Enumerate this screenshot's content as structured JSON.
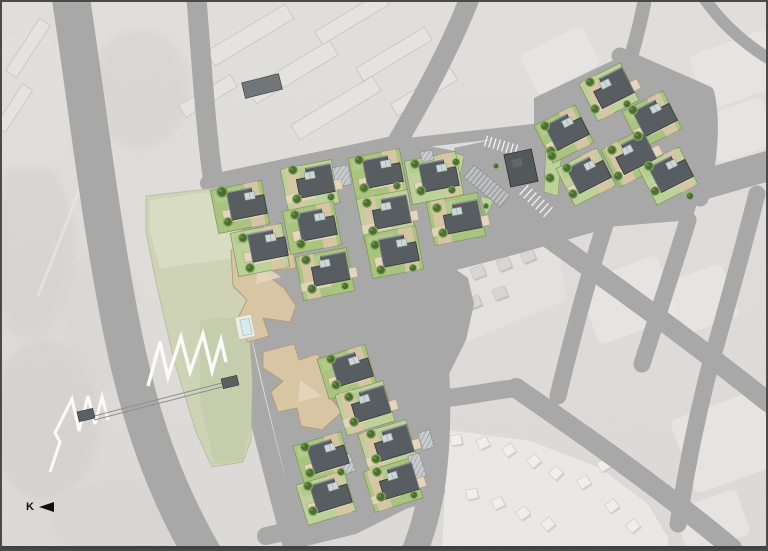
{
  "meta": {
    "description": "Architectural site plan of a housing development overlaid on a grayscale aerial photograph",
    "width": 768,
    "height": 551
  },
  "north_indicator": {
    "label": "K"
  },
  "palette": {
    "road": "#a8a8a8",
    "aerialBase": "#dcdbd8",
    "aerialTop": "#e1e0dd",
    "aerialLight": "#e9e8e5",
    "aerialMid": "#cfcecb",
    "parkFill": "#ced3b5",
    "parkLight": "#dadec6",
    "parkDark": "#c3cba8",
    "lawnA": "#a9c47f",
    "lawnB": "#bdd29a",
    "lawnStroke": "#7c9454",
    "tan": "#d8c5a4",
    "tanLight": "#e4d6bb",
    "tanStroke": "#b39c76",
    "roof": "#585d62",
    "roofDark": "#33383c",
    "roofLight": "#8a9094",
    "sky": "#cdd8d5",
    "skyStroke": "#8fa3a8",
    "treeOuter": "#86aa60",
    "treeInner": "#4b6e33",
    "treeDot": "#6d9449",
    "poolFill": "#d7ecf0",
    "poolStroke": "#9cc0c9",
    "deck": "#efece4",
    "darkBld": "#53585b",
    "darkBldEdge": "#2e3234",
    "hatchBg": "#c9ccce",
    "hatchLine": "#8f9498",
    "stall": "#8a8d8f",
    "stallBand": "#bfc1c1",
    "white": "#f4f4f2",
    "exHouse": "#d8d7d4",
    "exShadow": "#b9b8b5",
    "subHouse": "#f2f1ee",
    "subShadow": "#c9c8c5",
    "aptBar": "#e6e5e2",
    "aptStroke": "#c6c5c2",
    "aptPool": "#6e7478",
    "bridge": "#8f8f8d",
    "zigzag": "#fbfbf9",
    "frame": "#4a4a4a",
    "frameBottom": "#414141"
  },
  "aerial": {
    "blobs": [
      [
        30,
        250,
        45,
        90,
        "#d2d1ce",
        0.5
      ],
      [
        45,
        420,
        55,
        80,
        "#cdccc9",
        0.45
      ],
      [
        28,
        100,
        50,
        70,
        "#e3e2df",
        0.6
      ],
      [
        120,
        520,
        70,
        40,
        "#d5d4d1",
        0.5
      ],
      [
        140,
        90,
        50,
        60,
        "#d0cfcc",
        0.4
      ],
      [
        330,
        470,
        60,
        40,
        "#e6e5e2",
        0.5
      ],
      [
        100,
        320,
        40,
        70,
        "#d8d7d4",
        0.5
      ]
    ],
    "trail": "M96,140 C80,190 60,240 38,296",
    "bars": [
      [
        250,
        35,
        92,
        17,
        -31
      ],
      [
        293,
        72,
        95,
        17,
        -31
      ],
      [
        336,
        108,
        95,
        17,
        -31
      ],
      [
        352,
        18,
        78,
        15,
        -31
      ],
      [
        394,
        54,
        80,
        15,
        -31
      ],
      [
        424,
        92,
        70,
        14,
        -31
      ],
      [
        208,
        96,
        60,
        14,
        -31
      ],
      [
        28,
        48,
        62,
        13,
        -57
      ],
      [
        14,
        108,
        50,
        12,
        -57
      ]
    ],
    "apt_pool": [
      262,
      86,
      38,
      16,
      -14
    ],
    "blocks": [
      [
        628,
        300,
        84,
        66,
        -20
      ],
      [
        700,
        300,
        64,
        56,
        -20
      ],
      [
        726,
        442,
        92,
        78,
        -20
      ],
      [
        737,
        70,
        82,
        58,
        -20
      ],
      [
        712,
        522,
        66,
        48,
        -20
      ],
      [
        740,
        130,
        60,
        50,
        -20
      ],
      [
        560,
        60,
        70,
        44,
        -27
      ]
    ],
    "mid_block": "372,292 540,243 560,252 566,300 442,352 386,332",
    "mid_houses": [
      [
        400,
        298
      ],
      [
        426,
        290
      ],
      [
        452,
        281
      ],
      [
        478,
        272
      ],
      [
        504,
        264
      ],
      [
        528,
        256
      ],
      [
        396,
        327
      ],
      [
        422,
        319
      ],
      [
        448,
        310
      ],
      [
        474,
        302
      ],
      [
        500,
        293
      ]
    ],
    "mid_house_rot": -21,
    "sub_block": "448,430 530,441 600,468 648,504 668,538 668,551 442,551",
    "sub_houses": [
      [
        456,
        440,
        -10
      ],
      [
        483,
        443,
        -25
      ],
      [
        509,
        450,
        -35
      ],
      [
        534,
        461,
        -40
      ],
      [
        556,
        473,
        -45
      ],
      [
        472,
        494,
        -12
      ],
      [
        498,
        503,
        -25
      ],
      [
        523,
        513,
        -35
      ],
      [
        548,
        524,
        -40
      ],
      [
        584,
        482,
        -30
      ],
      [
        604,
        465,
        -30
      ],
      [
        612,
        506,
        -35
      ],
      [
        633,
        526,
        -40
      ]
    ]
  },
  "ground_areas": [
    "226,186 398,142 452,152 468,162 492,240 462,252 432,264 424,298 432,380 438,462 420,502 356,534 298,548 284,472 266,398 250,330 234,262",
    "454,148 546,128 560,162 562,224 476,242",
    "534,98 622,56 706,94 712,152 692,220 546,232 534,152",
    "388,270 418,264 448,264 468,278 474,304 466,340 450,372 436,398 426,380 418,312"
  ],
  "roads": [
    {
      "d": "M70,-8 C88,110 100,220 122,330 C140,420 165,490 205,558",
      "w": 38
    },
    {
      "d": "M196,-8 C202,70 206,130 213,180 C222,240 232,300 248,370 C262,430 278,490 296,558",
      "w": 20
    },
    {
      "d": "M208,183 L398,143",
      "w": 16
    },
    {
      "d": "M472,-8 C452,45 422,100 396,144",
      "w": 20
    },
    {
      "d": "M394,145 C420,152 446,155 466,160",
      "w": 13
    },
    {
      "d": "M394,145 C440,140 500,133 546,128",
      "w": 11
    },
    {
      "d": "M468,157 L490,242",
      "w": 20
    },
    {
      "d": "M381,272 C480,252 600,214 768,166",
      "w": 30
    },
    {
      "d": "M424,268 C434,330 442,400 434,470 C430,510 420,538 412,558",
      "w": 26
    },
    {
      "d": "M266,536 C330,522 380,508 436,490",
      "w": 18
    },
    {
      "d": "M446,398 C470,396 494,390 518,388",
      "w": 18
    },
    {
      "d": "M540,232 C610,282 680,332 768,402",
      "w": 20
    },
    {
      "d": "M516,388 C580,432 660,488 732,548",
      "w": 20
    },
    {
      "d": "M614,196 C596,252 580,305 558,396",
      "w": 17
    },
    {
      "d": "M688,220 C672,272 656,320 642,364",
      "w": 17
    },
    {
      "d": "M757,194 C742,252 726,310 710,366 C696,420 686,470 678,524",
      "w": 17
    },
    {
      "d": "M620,56 C650,70 680,82 706,94 C712,120 710,158 700,198",
      "w": 17
    },
    {
      "d": "M630,60 C636,40 642,18 646,-8",
      "w": 14
    },
    {
      "d": "M700,-8 C718,20 742,42 768,58",
      "w": 12
    }
  ],
  "park": {
    "outline": "146,196 226,187 238,202 244,252 248,312 252,380 251,440 243,462 212,467 196,432 174,360 156,282 146,232",
    "patch_light": "150,200 224,190 234,210 238,258 160,268 150,232",
    "patch_dark": "200,320 248,316 251,420 243,460 214,464 200,400",
    "zigzag_main": "148,386 160,342 168,377 181,337 190,372 203,334 212,371 221,340 226,362",
    "zigzag_left": "50,472 60,442 55,433 72,399 79,431 88,396 95,424 102,397 108,420"
  },
  "bridge": {
    "lines": [
      [
        94,
        416,
        222,
        383
      ],
      [
        94,
        420,
        222,
        387
      ]
    ],
    "piers": [
      [
        86,
        415,
        16,
        10,
        -13
      ],
      [
        230,
        382,
        16,
        10,
        -13
      ]
    ]
  },
  "parking": {
    "ladder": {
      "x1": 469,
      "y1": 171,
      "x2": 505,
      "y2": 201,
      "n": 11,
      "len": 16
    },
    "white_rows": [
      {
        "x1": 524,
        "y1": 190,
        "x2": 548,
        "y2": 212,
        "n": 6,
        "len": 13
      },
      {
        "x1": 486,
        "y1": 141,
        "x2": 516,
        "y2": 150,
        "n": 7,
        "len": 11
      }
    ],
    "greens": [
      "546,146 562,148 558,196 544,192",
      "480,196 494,200 486,216",
      "452,152 464,156 460,176 450,172"
    ],
    "dark_building": {
      "x": 521,
      "y": 168,
      "w": 28,
      "h": 33,
      "rot": -12
    }
  },
  "community_buildings": [
    {
      "points": "231,250 268,240 293,252 296,268 262,272 284,288 296,306 290,322 263,318 269,336 248,342 236,322 247,300 233,286",
      "inner": "258,262 281,277 256,284"
    },
    {
      "points": "263,352 294,344 299,360 317,354 341,388 332,400 342,412 322,430 301,426 297,408 278,412 271,392 283,381 263,368",
      "inner": "300,380 322,396 298,402"
    }
  ],
  "pool": {
    "deck": [
      245,
      327,
      16,
      22,
      -12
    ],
    "water": [
      246,
      327,
      9,
      16,
      -12
    ]
  },
  "clusters": [
    {
      "name": "upper",
      "rot": -11,
      "pw": 52,
      "ph": 44,
      "parcels": [
        {
          "x": 240,
          "y": 207,
          "t": 0,
          "f": 0
        },
        {
          "x": 260,
          "y": 250,
          "t": 1,
          "f": 0
        },
        {
          "x": 310,
          "y": 186,
          "t": 1,
          "f": 1
        },
        {
          "x": 312,
          "y": 228,
          "t": 0,
          "f": 0
        },
        {
          "x": 325,
          "y": 274,
          "t": 0,
          "f": 1
        },
        {
          "x": 378,
          "y": 175,
          "t": 0,
          "f": 0
        },
        {
          "x": 386,
          "y": 216,
          "t": 1,
          "f": 1
        },
        {
          "x": 394,
          "y": 252,
          "t": 0,
          "f": 0
        },
        {
          "x": 434,
          "y": 178,
          "t": 1,
          "f": 0
        },
        {
          "x": 456,
          "y": 219,
          "t": 0,
          "f": 1
        }
      ],
      "houses": [
        {
          "x": 247,
          "y": 203,
          "f": 0
        },
        {
          "x": 268,
          "y": 245,
          "f": 0
        },
        {
          "x": 315,
          "y": 181,
          "f": 1
        },
        {
          "x": 317,
          "y": 224,
          "f": 0
        },
        {
          "x": 330,
          "y": 269,
          "f": 1
        },
        {
          "x": 383,
          "y": 171,
          "f": 0
        },
        {
          "x": 391,
          "y": 212,
          "f": 1
        },
        {
          "x": 399,
          "y": 250,
          "f": 0
        },
        {
          "x": 439,
          "y": 175,
          "f": 0
        },
        {
          "x": 462,
          "y": 217,
          "f": 1
        }
      ]
    },
    {
      "name": "right",
      "rot": -27,
      "pw": 46,
      "ph": 42,
      "parcels": [
        {
          "x": 564,
          "y": 134,
          "t": 0,
          "f": 0
        },
        {
          "x": 609,
          "y": 92,
          "t": 1,
          "f": 1
        },
        {
          "x": 652,
          "y": 120,
          "t": 0,
          "f": 0
        },
        {
          "x": 586,
          "y": 177,
          "t": 1,
          "f": 0
        },
        {
          "x": 631,
          "y": 158,
          "t": 0,
          "f": 1
        },
        {
          "x": 668,
          "y": 176,
          "t": 1,
          "f": 0
        }
      ],
      "houses": [
        {
          "x": 567,
          "y": 130,
          "f": 0
        },
        {
          "x": 612,
          "y": 88,
          "f": 1
        },
        {
          "x": 655,
          "y": 116,
          "f": 0
        },
        {
          "x": 589,
          "y": 173,
          "f": 0
        },
        {
          "x": 634,
          "y": 154,
          "f": 1
        },
        {
          "x": 671,
          "y": 172,
          "f": 0
        }
      ]
    },
    {
      "name": "lower",
      "rot": -17,
      "pw": 50,
      "ph": 42,
      "parcels": [
        {
          "x": 347,
          "y": 372,
          "t": 0,
          "f": 0
        },
        {
          "x": 365,
          "y": 408,
          "t": 1,
          "f": 1
        },
        {
          "x": 323,
          "y": 459,
          "t": 0,
          "f": 0
        },
        {
          "x": 388,
          "y": 447,
          "t": 1,
          "f": 1
        },
        {
          "x": 326,
          "y": 498,
          "t": 1,
          "f": 0
        },
        {
          "x": 393,
          "y": 485,
          "t": 0,
          "f": 1
        }
      ],
      "houses": [
        {
          "x": 352,
          "y": 368,
          "f": 0
        },
        {
          "x": 370,
          "y": 404,
          "f": 1
        },
        {
          "x": 328,
          "y": 455,
          "f": 0
        },
        {
          "x": 393,
          "y": 443,
          "f": 1
        },
        {
          "x": 331,
          "y": 494,
          "f": 0
        },
        {
          "x": 398,
          "y": 481,
          "f": 1
        }
      ]
    }
  ],
  "hatches": [
    [
      342,
      176,
      16,
      20,
      -11
    ],
    [
      427,
      156,
      12,
      10,
      -11
    ],
    [
      347,
      464,
      12,
      18,
      -17
    ],
    [
      417,
      466,
      12,
      24,
      -17
    ],
    [
      426,
      440,
      12,
      18,
      -17
    ]
  ],
  "trees": [
    [
      222,
      192,
      6
    ],
    [
      228,
      222,
      5
    ],
    [
      243,
      238,
      5
    ],
    [
      250,
      268,
      5
    ],
    [
      293,
      170,
      5
    ],
    [
      297,
      199,
      5
    ],
    [
      331,
      197,
      4
    ],
    [
      295,
      215,
      5
    ],
    [
      301,
      244,
      5
    ],
    [
      306,
      260,
      5
    ],
    [
      312,
      289,
      5
    ],
    [
      345,
      286,
      4
    ],
    [
      359,
      160,
      5
    ],
    [
      364,
      188,
      5
    ],
    [
      397,
      186,
      4
    ],
    [
      367,
      203,
      5
    ],
    [
      373,
      231,
      5
    ],
    [
      375,
      245,
      5
    ],
    [
      381,
      270,
      5
    ],
    [
      413,
      268,
      4
    ],
    [
      415,
      164,
      5
    ],
    [
      421,
      191,
      5
    ],
    [
      452,
      190,
      4
    ],
    [
      437,
      208,
      5
    ],
    [
      443,
      233,
      5
    ],
    [
      545,
      126,
      5
    ],
    [
      551,
      151,
      5
    ],
    [
      590,
      82,
      5
    ],
    [
      595,
      109,
      5
    ],
    [
      627,
      104,
      4
    ],
    [
      633,
      110,
      5
    ],
    [
      638,
      136,
      5
    ],
    [
      567,
      168,
      5
    ],
    [
      573,
      194,
      5
    ],
    [
      612,
      150,
      5
    ],
    [
      618,
      176,
      5
    ],
    [
      649,
      166,
      5
    ],
    [
      655,
      191,
      5
    ],
    [
      690,
      196,
      4
    ],
    [
      331,
      359,
      5
    ],
    [
      336,
      385,
      5
    ],
    [
      349,
      397,
      5
    ],
    [
      354,
      422,
      5
    ],
    [
      305,
      447,
      5
    ],
    [
      310,
      473,
      5
    ],
    [
      341,
      472,
      4
    ],
    [
      371,
      434,
      5
    ],
    [
      376,
      459,
      5
    ],
    [
      308,
      486,
      5
    ],
    [
      313,
      511,
      5
    ],
    [
      377,
      472,
      5
    ],
    [
      381,
      497,
      5
    ],
    [
      414,
      495,
      4
    ],
    [
      552,
      156,
      5
    ],
    [
      550,
      178,
      5
    ],
    [
      456,
      162,
      4
    ],
    [
      486,
      206,
      3
    ],
    [
      496,
      166,
      3
    ]
  ]
}
